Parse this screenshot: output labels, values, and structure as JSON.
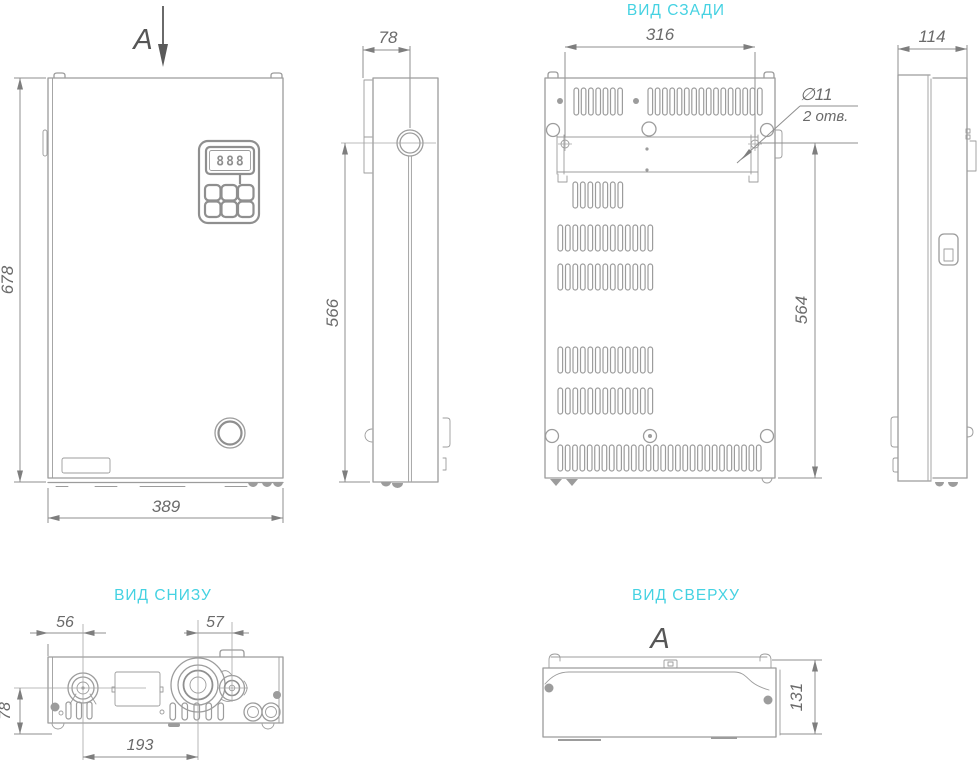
{
  "titles": {
    "rear": "ВИД СЗАДИ",
    "bottom": "ВИД СНИЗУ",
    "top": "ВИД СВЕРХУ"
  },
  "section": {
    "front": "A",
    "top": "A"
  },
  "dims": {
    "front_height": "678",
    "front_width": "389",
    "side_depth": "78",
    "side_height": "566",
    "rear_mount_width": "316",
    "rear_height": "564",
    "right_depth": "114",
    "bottom_left": "56",
    "bottom_mid": "57",
    "bottom_front": "78",
    "bottom_span": "193",
    "top_depth": "131"
  },
  "notes": {
    "hole_dia": "∅11",
    "hole_qty": "2 отв."
  },
  "display": {
    "digits": "888"
  },
  "colors": {
    "line": "#9c9c9c",
    "dim_text": "#6a6a6a",
    "title_accent": "#45d2e2",
    "section_dark": "#565656"
  }
}
